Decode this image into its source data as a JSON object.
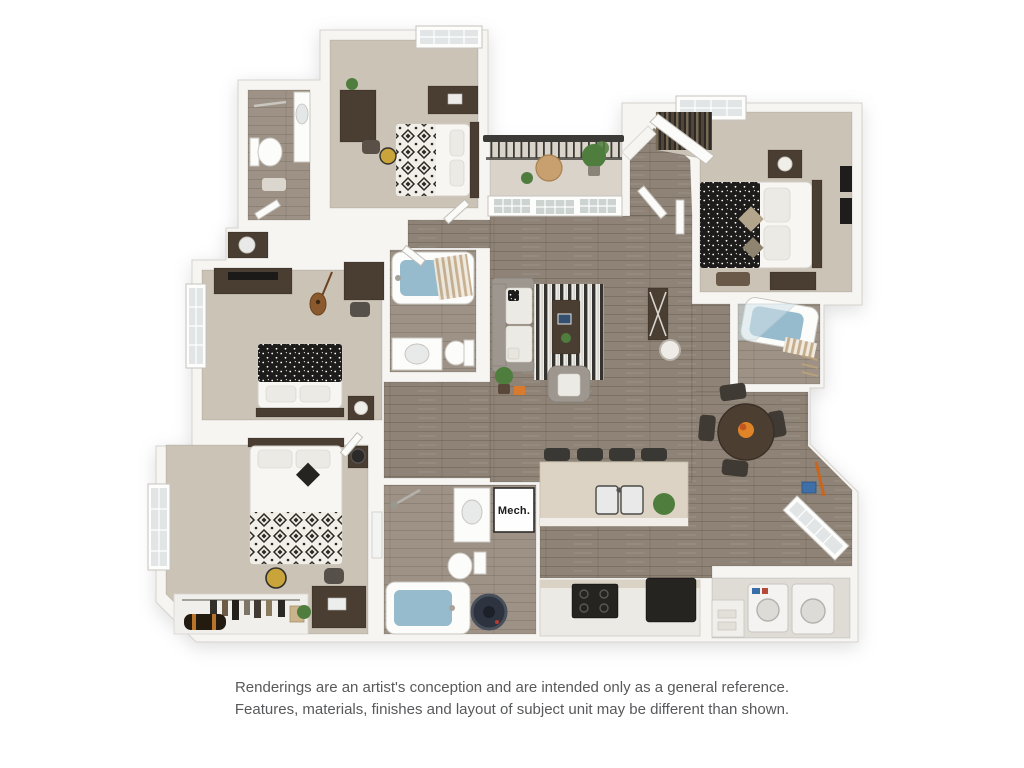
{
  "page": {
    "background": "#ffffff"
  },
  "floorplan": {
    "type": "3d-apartment-floor-plan-rendering",
    "mech_label": "Mech.",
    "colors": {
      "wall": "#f6f5f2",
      "wall_edge": "#d6d3cd",
      "wood": "#8e8376",
      "wood_light": "#9d9285",
      "carpet": "#cbc3b6",
      "balcony": "#d9d3ca",
      "water": "#96bbcd",
      "dark_wood": "#4a3d31",
      "black_appliance": "#262421",
      "sofa": "#9d978f",
      "rug_dark": "#35332f",
      "rug_light": "#f0ede7",
      "counter_cream": "#ddd3c4",
      "green": "#4f7d3d",
      "orange": "#dd7b2c",
      "rail": "#3c3a37",
      "duvet": "#1d1c1a",
      "glass": "#ccd3d1",
      "white_furn": "#f7f6f3",
      "furn_stroke": "#d2cec7",
      "text": "#58595b"
    }
  },
  "disclaimer": {
    "line1": "Renderings are an artist's conception and are intended only as a general reference.",
    "line2": "Features, materials, finishes and layout of subject unit may be different than shown."
  }
}
